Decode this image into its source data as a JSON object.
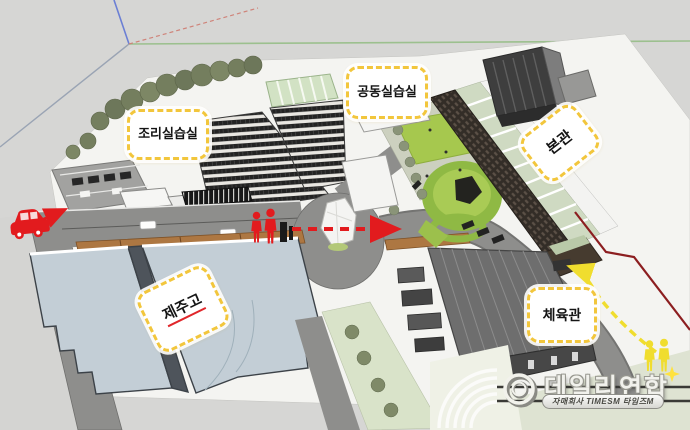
{
  "scene": {
    "description_labels": {
      "cooking_lab": "조리실습실",
      "shared_lab": "공동실습실",
      "main_hall": "본관",
      "jeju_high": "제주고",
      "gym": "체육관"
    },
    "colors": {
      "background": "#d6d6d4",
      "route_red": "#e21b1e",
      "route_yellow": "#f0dd2e",
      "callout_border": "#f2c63c",
      "boundary_red": "#8c1e20",
      "lawn_green": "#a6c84e"
    },
    "icons": {
      "car": "red-suv-side-view",
      "pedestrians_red": "two-red-person-figures",
      "pedestrians_yellow": "two-yellow-person-figures",
      "route_red_arrow": "dashed-arrow-right",
      "route_yellow_arrow": "dashed-curved-arrow",
      "sparkle": "✦"
    }
  },
  "watermark": {
    "brand": "데일리연합",
    "tagline": "자매회사 TIMESM 타임즈M"
  }
}
